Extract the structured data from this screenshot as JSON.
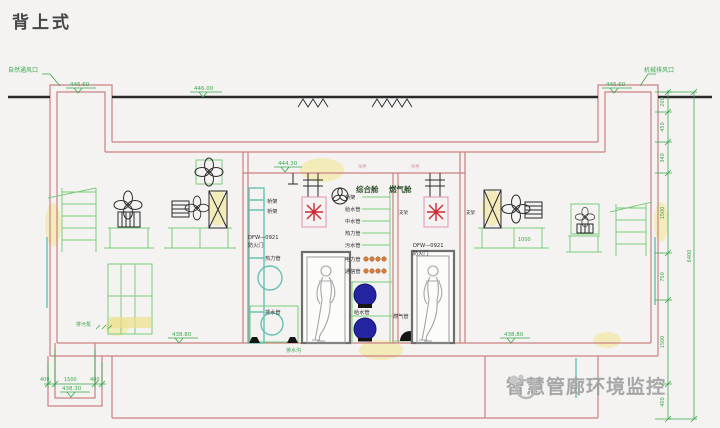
{
  "title": "背上式",
  "watermark": "智慧管廊环境监控",
  "cabins": {
    "left": "综合舱",
    "right": "燃气舱"
  },
  "fire_door": {
    "model": "DFW—0921",
    "label": "防火门"
  },
  "left_rack": {
    "rows": [
      "桥架",
      "桥架",
      "热力管",
      "排水管"
    ]
  },
  "pipe_rack": {
    "green_rows": [
      "桥架",
      "给水管",
      "中水管",
      "热力管",
      "污水管"
    ],
    "orange_rows": [
      "电力管",
      "通信管"
    ]
  },
  "pipes": {
    "water": "给水管",
    "gas": "燃气管"
  },
  "labels": {
    "vent_left": "自然通风口",
    "vent_right": "机械排风口",
    "drain": "排水沟",
    "pump": "排污泵",
    "bracket": "支架",
    "hanger": "吊件"
  },
  "elevations": {
    "shaft_left": "446.60",
    "ground": "446.00",
    "shaft_right": "446.60",
    "roof_center": "444.30",
    "floor_left": "438.80",
    "floor_right": "438.80",
    "pit": "438.30"
  },
  "dimensions": {
    "right_chain": [
      "200",
      "450",
      "340",
      "1500",
      "750",
      "1500",
      "400"
    ],
    "right_total": "6400",
    "pit": [
      "400",
      "1500",
      "400"
    ],
    "platform": "1000"
  },
  "colors": {
    "structure": "#c98183",
    "annotation_green": "#3aa84e",
    "orange": "#d27c3f",
    "red_device": "#cc2936",
    "blue_pipe": "#2424a0",
    "teal": "#66c2b5",
    "watermark_gray": "#a0a0a0",
    "yellow_highlight": "#f3e27a"
  }
}
